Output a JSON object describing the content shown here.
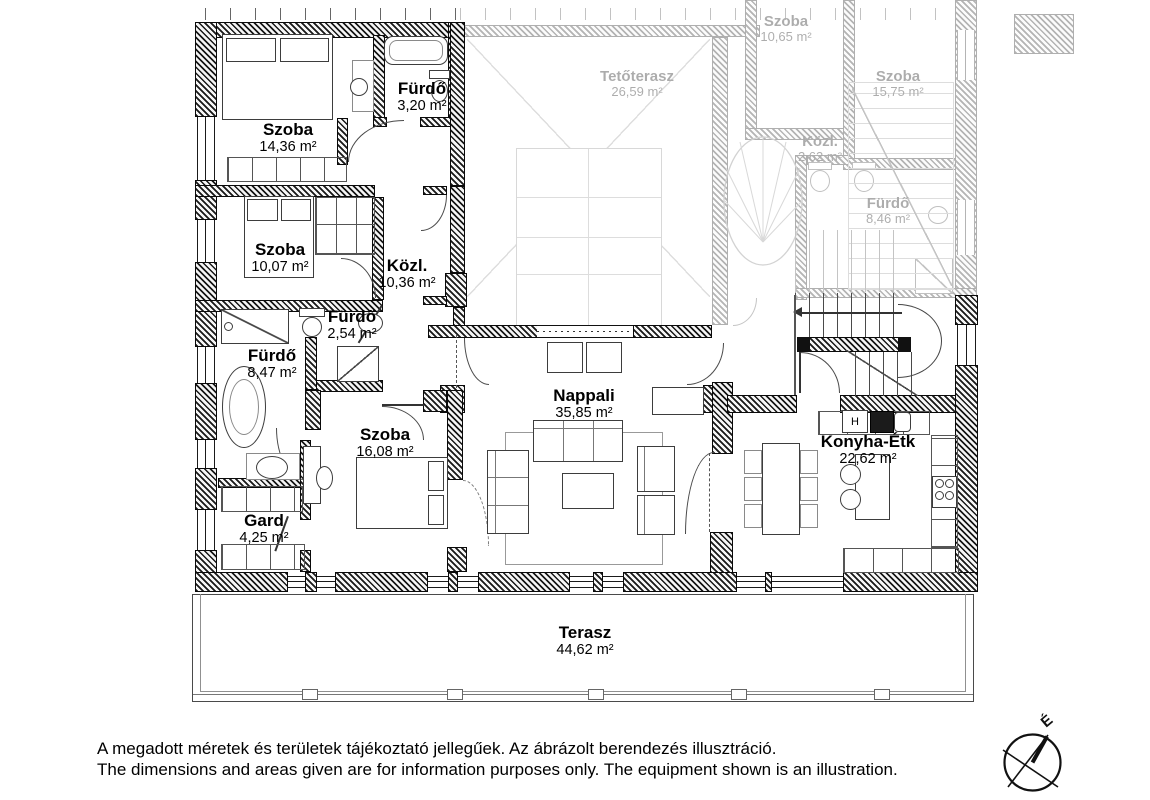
{
  "plan": {
    "rooms": [
      {
        "name": "Szoba",
        "area": "14,36 m²"
      },
      {
        "name": "Fürdő",
        "area": "3,20 m²"
      },
      {
        "name": "Szoba",
        "area": "10,07 m²"
      },
      {
        "name": "Közl.",
        "area": "10,36 m²"
      },
      {
        "name": "Fürdő",
        "area": "2,54 m²"
      },
      {
        "name": "Fürdő",
        "area": "8,47 m²"
      },
      {
        "name": "Szoba",
        "area": "16,08 m²"
      },
      {
        "name": "Gard",
        "area": "4,25 m²"
      },
      {
        "name": "Nappali",
        "area": "35,85 m²"
      },
      {
        "name": "Konyha-Étk",
        "area": "22,62 m²"
      },
      {
        "name": "Terasz",
        "area": "44,62 m²"
      }
    ],
    "faded_rooms": [
      {
        "name": "Tetőterasz",
        "area": "26,59 m²"
      },
      {
        "name": "Szoba",
        "area": "10,65 m²"
      },
      {
        "name": "Szoba",
        "area": "15,75 m²"
      },
      {
        "name": "Közl.",
        "area": "2,62 m²"
      },
      {
        "name": "Fürdő",
        "area": "8,46 m²"
      }
    ],
    "kitchen": {
      "fridge_label": "H"
    },
    "compass": {
      "north_label": "É"
    }
  },
  "footer": {
    "line1_hu": "A megadott méretek és területek tájékoztató jellegűek. Az ábrázolt berendezés illusztráció.",
    "line2_en": "The dimensions and areas given are for information purposes only. The equipment shown is an illustration."
  }
}
